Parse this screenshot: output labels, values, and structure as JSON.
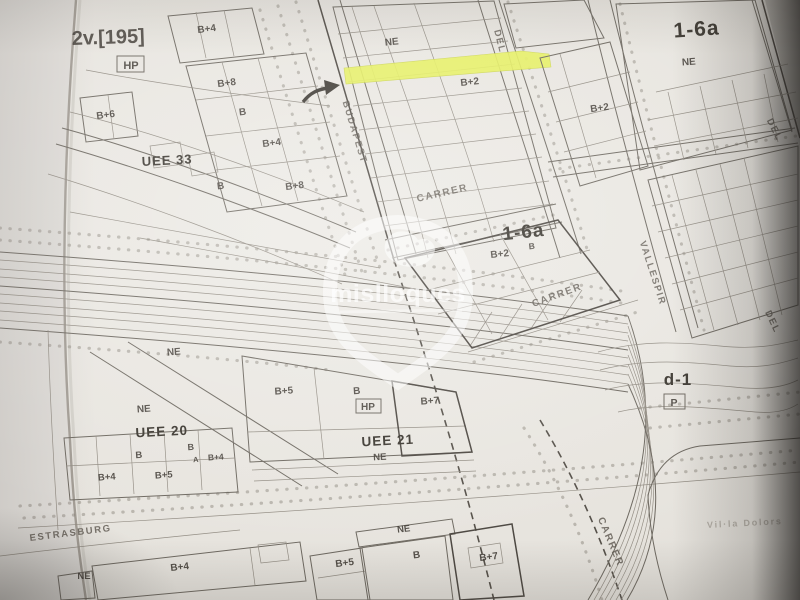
{
  "photo": {
    "watermark": "mislloques",
    "site_note": "Vil·la Dolors"
  },
  "colors": {
    "highlight": "#e6f154",
    "paper": "#e8e5df",
    "ink": "#4d4841"
  },
  "labels": {
    "sheet_ref": "2v.[195]",
    "hp_badge_top": "HP",
    "hp_badge_mid": "HP",
    "parking_badge": "P",
    "zones": {
      "uee33": "UEE 33",
      "uee20": "UEE 20",
      "uee21": "UEE 21",
      "z16a_top": "1-6a",
      "z16a_mid": "1-6a",
      "d1": "d-1"
    },
    "streets": {
      "budapest": "BUDAPEST",
      "carrer_top": "CARRER",
      "carrer_mid": "CARRER",
      "carrer_bottom": "CARRER",
      "del_top": "DEL",
      "del_right_top": "DEL",
      "del_right_mid": "DEL",
      "vallespir": "VALLESPIR",
      "estrasburg": "ESTRASBURG"
    },
    "ne": {
      "top_center": "NE",
      "top_right": "NE",
      "uee20_a": "NE",
      "uee20_b": "NE",
      "uee21": "NE",
      "bottom_left": "NE",
      "bottom_mid": "NE"
    },
    "heights": {
      "tl_b4": "B+4",
      "tl_b8": "B+8",
      "tl_b6": "B+6",
      "tl_b": "B",
      "tl_b4b": "B+4",
      "tl_bb": "B",
      "tl_b8b": "B+8",
      "tc_b2": "B+2",
      "tr_b2": "B+2",
      "mid_b2": "B+2",
      "mid_b": "B",
      "u20_b": "B",
      "u20_bb": "B",
      "u20_a": "A",
      "u20_b4": "B+4",
      "u20_b4b": "B+4",
      "u20_b5": "B+5",
      "u21_b5": "B+5",
      "u21_b": "B",
      "u21_b7": "B+7",
      "bt_b4": "B+4",
      "bt_b5": "B+5",
      "bt_b": "B",
      "bt_b7": "B+7"
    }
  }
}
